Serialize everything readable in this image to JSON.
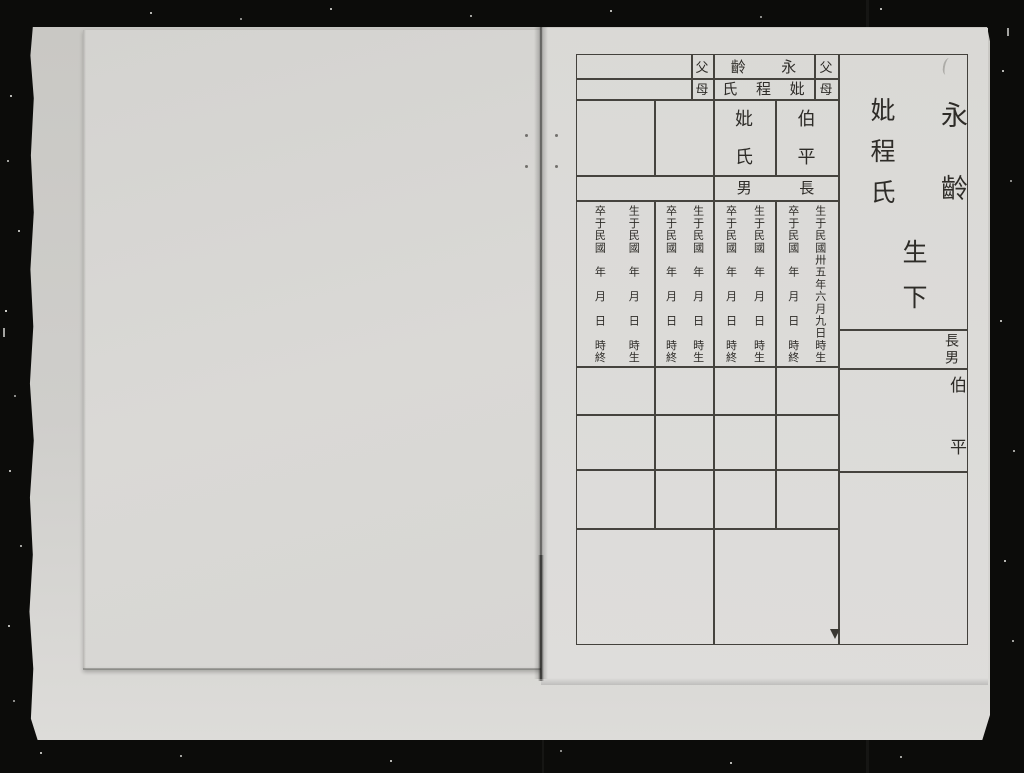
{
  "colors": {
    "film_black": "#0c0c0a",
    "page_gray": "#d9d8d5",
    "ink": "#2e2c28",
    "grid_line": "#45433e"
  },
  "table": {
    "parent_rows": [
      {
        "left_label": "父",
        "name_chars": [
          "永",
          "齡"
        ],
        "right_label": "父"
      },
      {
        "left_label": "母",
        "name_chars": [
          "妣",
          "程",
          "氏"
        ],
        "right_label": "母"
      }
    ],
    "mother_cell_chars": [
      "妣",
      "氏"
    ],
    "son_cell_chars": [
      "伯",
      "平"
    ],
    "son_header_chars": [
      "長",
      "男"
    ],
    "date_columns": [
      "卒于民國　年　月　日　時終",
      "生于民國　年　月　日　時生",
      "卒于民國　年　月　日　時終",
      "生于民國　年　月　日　時生",
      "卒于民國　年　月　日　時終",
      "生于民國　年　月　日　時生",
      "卒于民國　年　月　日　時終",
      "生于民國卅五年六月九日時生"
    ],
    "margin": {
      "inscription_name": "永齡",
      "inscription_mother": "妣程氏",
      "inscription_note": "生下",
      "son_label": "長男",
      "son_name": "伯平"
    }
  }
}
